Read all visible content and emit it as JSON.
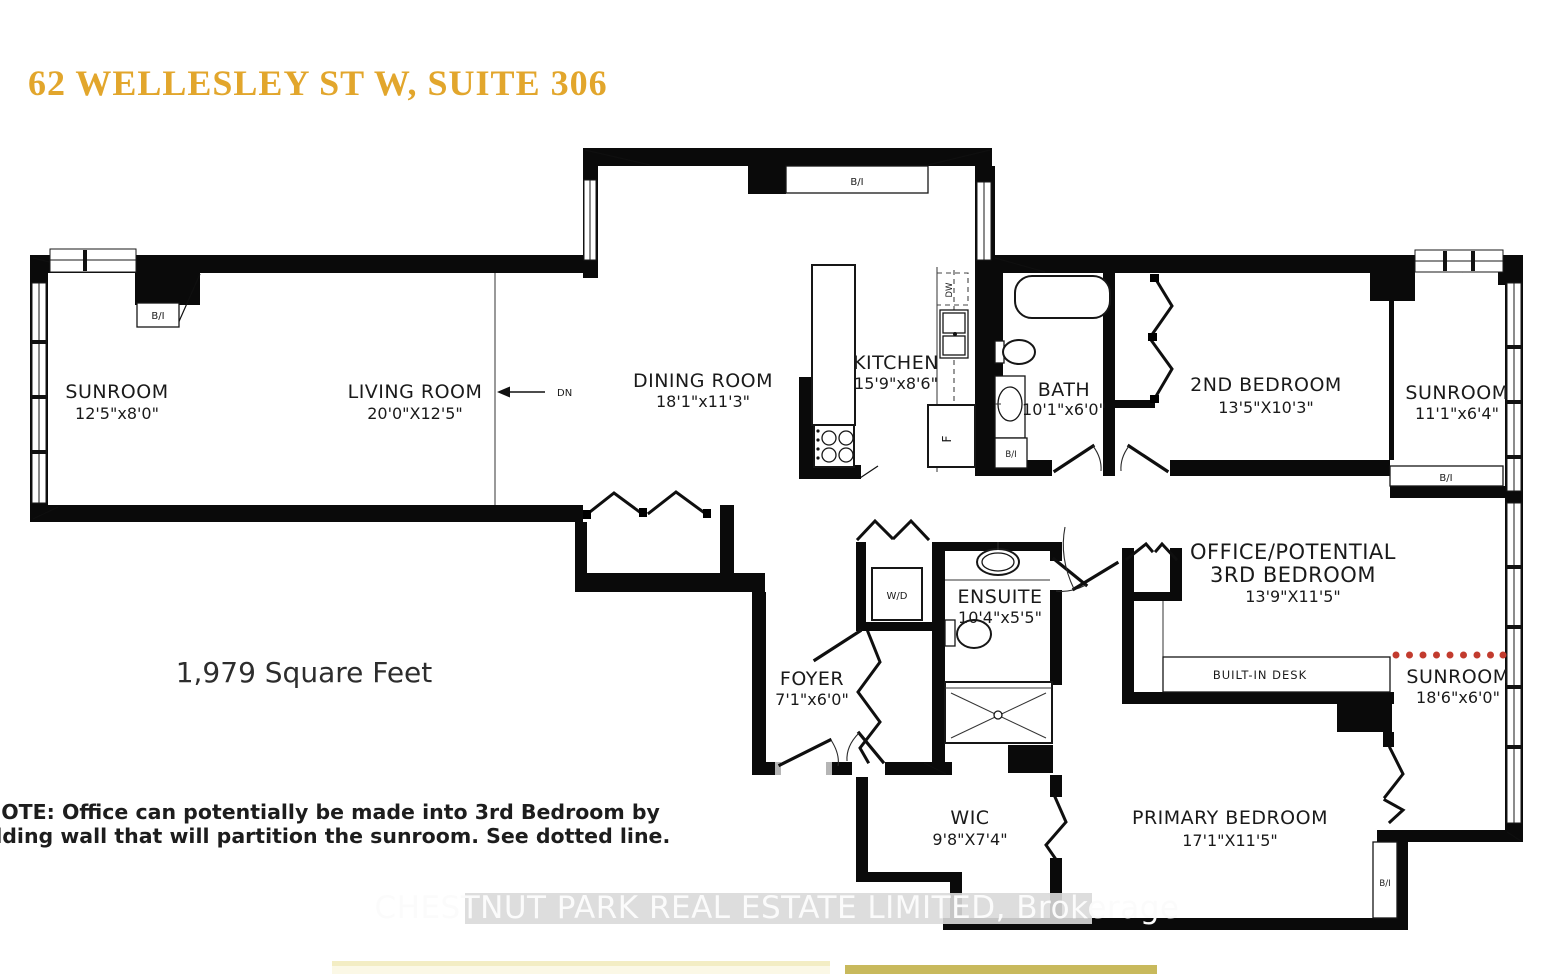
{
  "title": "62 WELLESLEY ST W, SUITE 306",
  "area_text": "1,979 Square Feet",
  "note": {
    "line1": "NOTE: Office can potentially be made into 3rd Bedroom by",
    "line2": "adding wall that will partition the sunroom. See dotted line."
  },
  "watermark": "CHESTNUT PARK REAL ESTATE LIMITED, Brokerage",
  "rooms": {
    "sunroom_left": {
      "name": "SUNROOM",
      "dims": "12'5\"x8'0\""
    },
    "living_room": {
      "name": "LIVING ROOM",
      "dims": "20'0\"X12'5\""
    },
    "dining_room": {
      "name": "DINING ROOM",
      "dims": "18'1\"x11'3\""
    },
    "kitchen": {
      "name": "KITCHEN",
      "dims": "15'9\"x8'6\""
    },
    "bath": {
      "name": "BATH",
      "dims": "10'1\"x6'0\""
    },
    "second_bedroom": {
      "name": "2ND BEDROOM",
      "dims": "13'5\"X10'3\""
    },
    "sunroom_right": {
      "name": "SUNROOM",
      "dims": "11'1\"x6'4\""
    },
    "office": {
      "name_line1": "OFFICE/POTENTIAL",
      "name_line2": "3RD BEDROOM",
      "dims": "13'9\"X11'5\""
    },
    "ensuite": {
      "name": "ENSUITE",
      "dims": "10'4\"x5'5\""
    },
    "foyer": {
      "name": "FOYER",
      "dims": "7'1\"x6'0\""
    },
    "sunroom_bottom": {
      "name": "SUNROOM",
      "dims": "18'6\"x6'0\""
    },
    "wic": {
      "name": "WIC",
      "dims": "9'8\"X7'4\""
    },
    "primary_bedroom": {
      "name": "PRIMARY BEDROOM",
      "dims": "17'1\"X11'5\""
    }
  },
  "labels": {
    "built_in": "B/I",
    "down": "DN",
    "washer_dryer": "W/D",
    "dishwasher": "DW",
    "fridge": "F",
    "built_in_desk": "BUILT-IN DESK"
  },
  "colors": {
    "title_gold": "#E2A62C",
    "dotted_line_red": "#C23B2E",
    "bar_light": "#F3EDC4",
    "bar_gold": "#C8B95C"
  }
}
